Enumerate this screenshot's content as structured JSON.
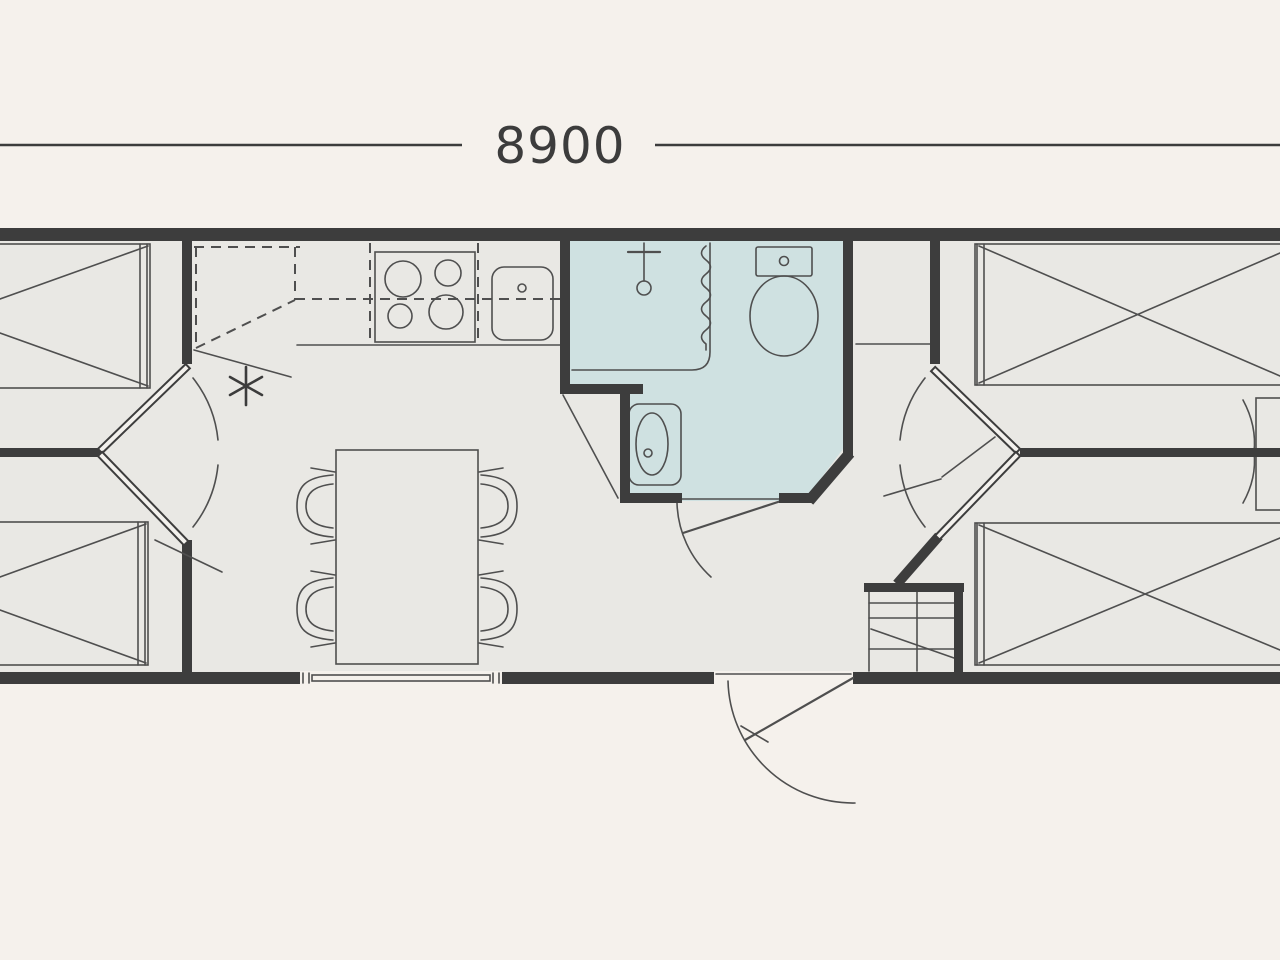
{
  "dimension": {
    "label": "8900"
  },
  "colors": {
    "background": "#f5f1ec",
    "floor": "#e9e8e4",
    "wall": "#3d3d3d",
    "line": "#4f4f4f",
    "bathroom": "#cfe1e1",
    "ink": "#3c3c3c"
  },
  "fixtures": {
    "bedrooms_left": 2,
    "bedrooms_right": 2,
    "beds": [
      "double-bed-top-left",
      "double-bed-bottom-left",
      "double-bed-top-right",
      "double-bed-bottom-right"
    ],
    "kitchen": [
      "overhead-cabinets-dashed",
      "stove-4-burner",
      "kitchen-sink",
      "flue-symbol"
    ],
    "bathroom": [
      "shower",
      "shower-curtain",
      "toilet",
      "washbasin"
    ],
    "living": [
      "dining-table",
      "chair",
      "chair",
      "chair",
      "chair"
    ],
    "other": [
      "bunk-bed-unit",
      "entrance-door",
      "window",
      "interior-doors",
      "wardrobe-right-edge",
      "hall-shelf"
    ]
  }
}
